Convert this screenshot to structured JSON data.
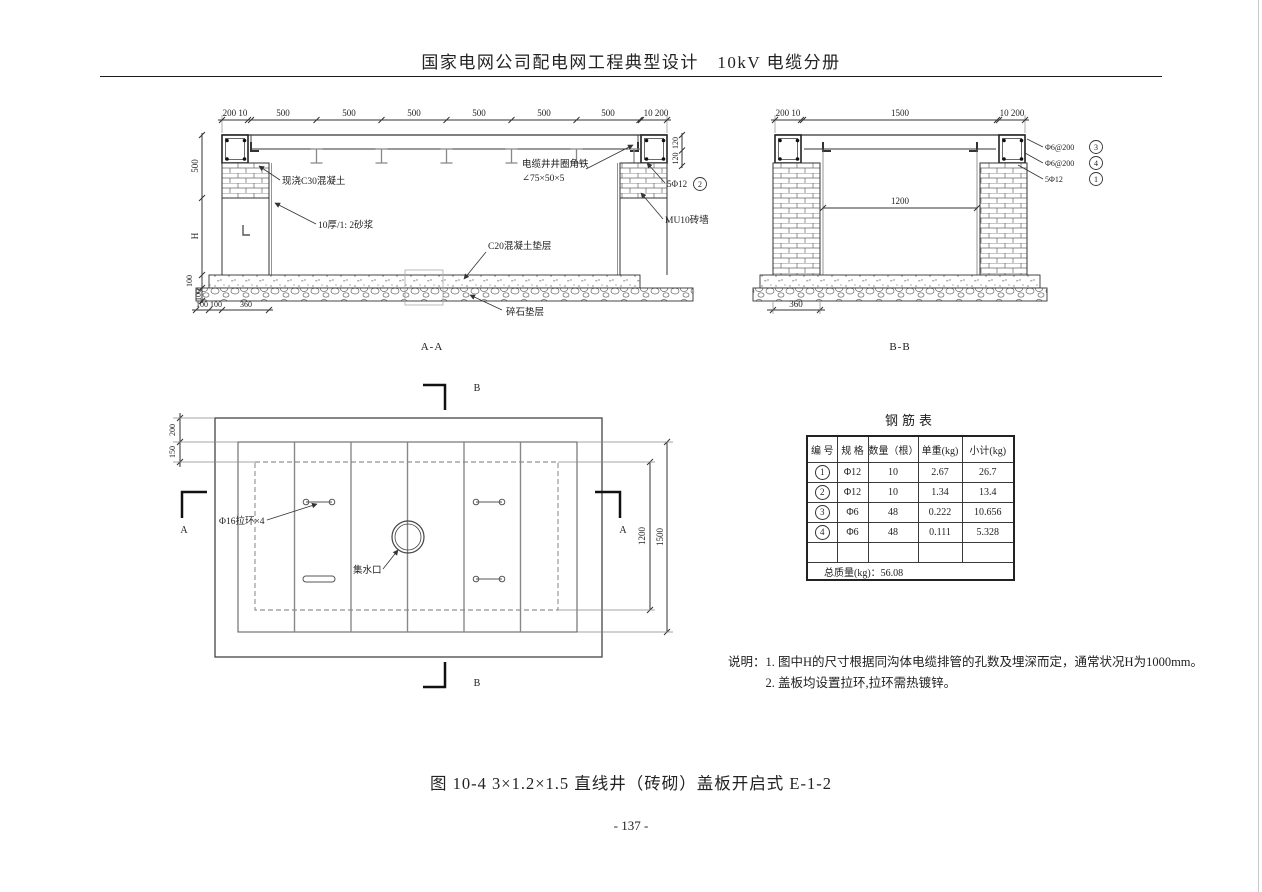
{
  "header": {
    "title": "国家电网公司配电网工程典型设计　10kV 电缆分册"
  },
  "section_aa": {
    "caption": "A-A",
    "top_dims": [
      "200 10",
      "500",
      "500",
      "500",
      "500",
      "500",
      "500",
      "10 200"
    ],
    "left_dims": [
      "500",
      "H",
      "100",
      "100"
    ],
    "bottom_dims": [
      "100",
      "100",
      "360"
    ],
    "right_dims": [
      "120",
      "120"
    ],
    "labels": {
      "cast_concrete": "现浇C30混凝土",
      "mortar": "10厚/1: 2砂浆",
      "angle_iron_line1": "电缆井井圈角铁",
      "angle_iron_line2": "∠75×50×5",
      "rebar": "5Φ12",
      "rebar_no": "2",
      "brick_wall": "MU10砖墙",
      "concrete_cushion": "C20混凝土垫层",
      "gravel_cushion": "碎石垫层"
    }
  },
  "section_bb": {
    "caption": "B-B",
    "top_dims": [
      "200 10",
      "1500",
      "10 200"
    ],
    "inner_dim": "1200",
    "bottom_dim": "360",
    "callouts": [
      {
        "text": "Φ6@200",
        "no": "3"
      },
      {
        "text": "Φ6@200",
        "no": "4"
      },
      {
        "text": "5Φ12",
        "no": "1"
      }
    ]
  },
  "plan": {
    "marker_a": "A",
    "marker_b": "B",
    "left_dims": [
      "200",
      "150"
    ],
    "right_dims": [
      "1200",
      "1500"
    ],
    "labels": {
      "pull_ring": "Φ16拉环×4",
      "water_inlet": "集水口"
    }
  },
  "rebar_table": {
    "title": "钢筋表",
    "headers": [
      "编 号",
      "规 格",
      "数量（根）",
      "单重(kg)",
      "小计(kg)"
    ],
    "rows": [
      {
        "no": "1",
        "spec": "Φ12",
        "qty": "10",
        "unit": "2.67",
        "subtotal": "26.7"
      },
      {
        "no": "2",
        "spec": "Φ12",
        "qty": "10",
        "unit": "1.34",
        "subtotal": "13.4"
      },
      {
        "no": "3",
        "spec": "Φ6",
        "qty": "48",
        "unit": "0.222",
        "subtotal": "10.656"
      },
      {
        "no": "4",
        "spec": "Φ6",
        "qty": "48",
        "unit": "0.111",
        "subtotal": "5.328"
      }
    ],
    "total": "总质量(kg)：56.08"
  },
  "notes": {
    "label": "说明：",
    "items": [
      "1. 图中H的尺寸根据同沟体电缆排管的孔数及埋深而定，通常状况H为1000mm。",
      "2. 盖板均设置拉环,拉环需热镀锌。"
    ]
  },
  "figure_caption": "图 10-4 3×1.2×1.5 直线井（砖砌）盖板开启式 E-1-2",
  "page_number": "- 137 -"
}
